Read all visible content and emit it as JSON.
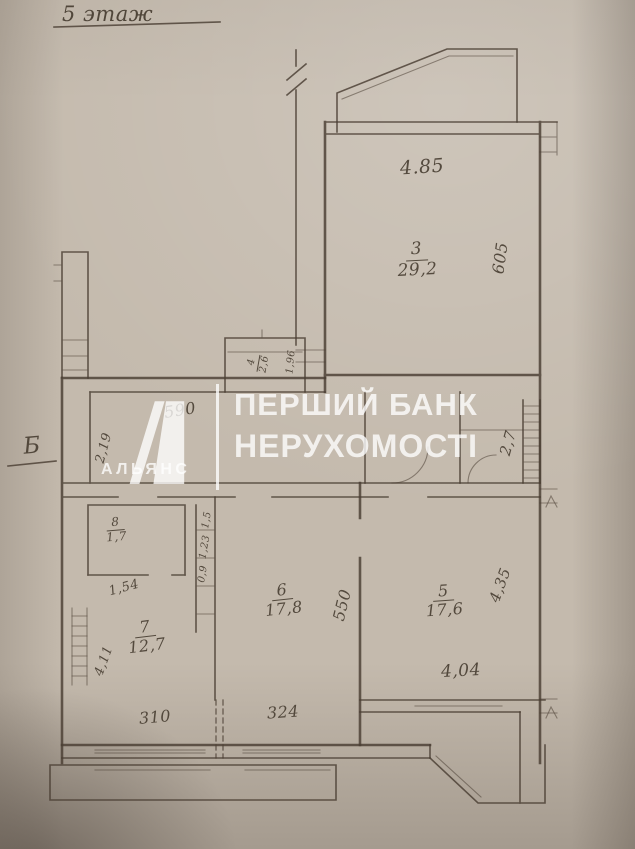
{
  "title": "5 этаж",
  "section_letter": "Б",
  "watermark": {
    "logo_letter": "А",
    "brand": "АЛЬЯНС",
    "line1": "ПЕРШИЙ БАНК",
    "line2": "НЕРУХОМОСТІ"
  },
  "rooms": {
    "r3": {
      "number": "3",
      "area": "29,2"
    },
    "r4": {
      "number": "4",
      "area": "2,6"
    },
    "r5": {
      "number": "5",
      "area": "17,6"
    },
    "r6": {
      "number": "6",
      "area": "17,8"
    },
    "r7": {
      "number": "7",
      "area": "12,7"
    },
    "r8": {
      "number": "8",
      "area": "1,7"
    }
  },
  "dimensions": {
    "room3_top": "4.85",
    "room3_right": "605",
    "hall_top": "590",
    "hall_left": "2,19",
    "room4_side": "1,96",
    "entry_side": "2,7",
    "closet_bottom": "1,54",
    "duct_1": "1,5",
    "duct_2": "1,23",
    "duct_3": "0,9",
    "room7_left": "4,11",
    "room6_side": "550",
    "room5_side": "4,35",
    "room5_bottom": "4,04",
    "window_room7": "310",
    "window_room6": "324"
  },
  "colors": {
    "paper": "#c4baad",
    "ink": "#4a3e33",
    "watermark": "#ffffff"
  }
}
